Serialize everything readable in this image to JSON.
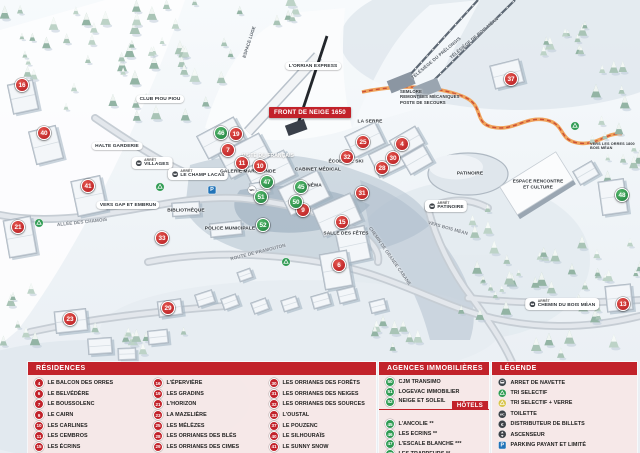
{
  "colors": {
    "legend_red": "#c2222a",
    "marker_red": "#cd2127",
    "marker_green": "#2f9b53",
    "parking_blue": "#2173b8",
    "luge_orange": "#f0a35c"
  },
  "map": {
    "banner": "FRONT DE NEIGE 1650",
    "stop_prefix": "ARRÊT",
    "red_markers": [
      {
        "n": "16",
        "x": 22,
        "y": 85
      },
      {
        "n": "40",
        "x": 44,
        "y": 133
      },
      {
        "n": "41",
        "x": 88,
        "y": 186
      },
      {
        "n": "21",
        "x": 18,
        "y": 227
      },
      {
        "n": "23",
        "x": 70,
        "y": 319
      },
      {
        "n": "29",
        "x": 168,
        "y": 308
      },
      {
        "n": "33",
        "x": 162,
        "y": 238
      },
      {
        "n": "19",
        "x": 236,
        "y": 134
      },
      {
        "n": "7",
        "x": 228,
        "y": 150
      },
      {
        "n": "11",
        "x": 242,
        "y": 163
      },
      {
        "n": "10",
        "x": 260,
        "y": 166
      },
      {
        "n": "9",
        "x": 303,
        "y": 210
      },
      {
        "n": "15",
        "x": 342,
        "y": 222
      },
      {
        "n": "31",
        "x": 362,
        "y": 193
      },
      {
        "n": "6",
        "x": 339,
        "y": 265
      },
      {
        "n": "25",
        "x": 363,
        "y": 142
      },
      {
        "n": "32",
        "x": 347,
        "y": 157
      },
      {
        "n": "4",
        "x": 402,
        "y": 144
      },
      {
        "n": "30",
        "x": 393,
        "y": 158
      },
      {
        "n": "28",
        "x": 382,
        "y": 168
      },
      {
        "n": "37",
        "x": 511,
        "y": 79
      },
      {
        "n": "13",
        "x": 623,
        "y": 304
      }
    ],
    "green_markers": [
      {
        "n": "46",
        "x": 221,
        "y": 133
      },
      {
        "n": "45",
        "x": 301,
        "y": 187
      },
      {
        "n": "47",
        "x": 267,
        "y": 182
      },
      {
        "n": "51",
        "x": 261,
        "y": 197
      },
      {
        "n": "50",
        "x": 296,
        "y": 202
      },
      {
        "n": "52",
        "x": 263,
        "y": 225
      },
      {
        "n": "48",
        "x": 622,
        "y": 195
      }
    ],
    "icons": [
      {
        "t": "parking",
        "x": 212,
        "y": 190
      },
      {
        "t": "wc-map",
        "x": 252,
        "y": 190
      },
      {
        "t": "recycle",
        "x": 39,
        "y": 223
      },
      {
        "t": "recycle",
        "x": 160,
        "y": 187
      },
      {
        "t": "recycle",
        "x": 286,
        "y": 262
      },
      {
        "t": "recycle",
        "x": 575,
        "y": 126
      }
    ],
    "labels": [
      {
        "t": "CLUB PIOU PIOU",
        "x": 160,
        "y": 99,
        "s": "pill"
      },
      {
        "t": "HALTE GARDERIE",
        "x": 117,
        "y": 146,
        "s": "pill"
      },
      {
        "t": "VILLAGES",
        "x": 152,
        "y": 163,
        "s": "bus"
      },
      {
        "t": "LE CHAMP LACAS",
        "x": 198,
        "y": 174,
        "s": "bus"
      },
      {
        "t": "VERS GAP ET EMBRUN",
        "x": 128,
        "y": 205,
        "s": "pill"
      },
      {
        "t": "GALERIE MARCHANDE",
        "x": 248,
        "y": 172,
        "s": "plain"
      },
      {
        "t": "BIBLIOTHÈQUE",
        "x": 186,
        "y": 211,
        "s": "plain"
      },
      {
        "t": "POLICE MUNICIPALE",
        "x": 230,
        "y": 229,
        "s": "plain"
      },
      {
        "t": "CABINET MÉDICAL",
        "x": 318,
        "y": 170,
        "s": "plain"
      },
      {
        "t": "CINÉMA",
        "x": 312,
        "y": 186,
        "s": "plain"
      },
      {
        "t": "ÉCOLE DE SKI",
        "x": 346,
        "y": 162,
        "s": "plain"
      },
      {
        "t": "LA SERRE",
        "x": 370,
        "y": 122,
        "s": "plain"
      },
      {
        "t": "SALLE DES FÊTES",
        "x": 346,
        "y": 234,
        "s": "plain"
      },
      {
        "t": "PISTE DU FRANÇAIS",
        "x": 268,
        "y": 156,
        "s": "white"
      },
      {
        "t": "SEMLORE\nREMONTÉES MÉCANIQUES\nPOSTE DE SECOURS",
        "x": 400,
        "y": 97,
        "s": "multi"
      },
      {
        "t": "ESPACE LUGE",
        "x": 249,
        "y": 42,
        "s": "rot",
        "r": -72
      },
      {
        "t": "L'ORRIAN EXPRESS",
        "x": 313,
        "y": 66,
        "s": "pill"
      },
      {
        "t": "TÉLÉSIÈGE DU PRÉLONGIS",
        "x": 436,
        "y": 58,
        "s": "rot",
        "r": -40
      },
      {
        "t": "TÉLÉSIÈGE DE BOIS MÉAN",
        "x": 474,
        "y": 38,
        "s": "rot",
        "r": -40
      },
      {
        "t": "PATINOIRE",
        "x": 470,
        "y": 174,
        "s": "plain"
      },
      {
        "t": "PATINOIRE",
        "x": 446,
        "y": 206,
        "s": "bus"
      },
      {
        "t": "ESPACE RENCONTRE\nET CULTURE",
        "x": 538,
        "y": 184,
        "s": "multi-c"
      },
      {
        "t": "VERS BOIS MÉAN",
        "x": 448,
        "y": 228,
        "s": "road",
        "r": 16
      },
      {
        "t": "VERS LES ORRES 1800\nBOIS MÉAN",
        "x": 590,
        "y": 146,
        "s": "tiny"
      },
      {
        "t": "CHEMIN DU BOIS MÉAN",
        "x": 562,
        "y": 304,
        "s": "bus"
      },
      {
        "t": "ALLÉE DES CHAMOIS",
        "x": 82,
        "y": 222,
        "s": "road",
        "r": -6
      },
      {
        "t": "ROUTE DE PRAMOUTON",
        "x": 258,
        "y": 252,
        "s": "road",
        "r": -14
      },
      {
        "t": "CHEMIN DE GRANDE CABANE",
        "x": 390,
        "y": 256,
        "s": "road",
        "r": 55
      }
    ]
  },
  "legend": {
    "residences": {
      "title": "RÉSIDENCES",
      "columns": [
        [
          {
            "n": "4",
            "label": "LE BALCON DES ORRES"
          },
          {
            "n": "6",
            "label": "LE BELVÉDÈRE"
          },
          {
            "n": "7",
            "label": "LE BOUSSOLENC"
          },
          {
            "n": "9",
            "label": "LE CAIRN"
          },
          {
            "n": "10",
            "label": "LES CARLINES"
          },
          {
            "n": "11",
            "label": "LES CEMBROS"
          },
          {
            "n": "15",
            "label": "LES ÉCRINS"
          }
        ],
        [
          {
            "n": "16",
            "label": "L'ÉPERVIÈRE"
          },
          {
            "n": "19",
            "label": "LES GRADINS"
          },
          {
            "n": "21",
            "label": "L'HORIZON"
          },
          {
            "n": "23",
            "label": "LA MAZELIÈRE"
          },
          {
            "n": "25",
            "label": "LES MÉLÈZES"
          },
          {
            "n": "28",
            "label": "LES ORRIANES DES BLÉS"
          },
          {
            "n": "29",
            "label": "LES ORRIANES DES CIMES"
          }
        ],
        [
          {
            "n": "30",
            "label": "LES ORRIANES DES FORÊTS"
          },
          {
            "n": "31",
            "label": "LES ORRIANES DES NEIGES"
          },
          {
            "n": "32",
            "label": "LES ORRIANES DES SOURCES"
          },
          {
            "n": "33",
            "label": "L'OUSTAL"
          },
          {
            "n": "37",
            "label": "LE POUZENC"
          },
          {
            "n": "40",
            "label": "LE SILHOURAÏS"
          },
          {
            "n": "41",
            "label": "LE SUNNY SNOW"
          }
        ]
      ]
    },
    "agences": {
      "title": "AGENCES IMMOBILIÈRES",
      "items": [
        {
          "n": "50",
          "label": "CJM TRANSIMO"
        },
        {
          "n": "51",
          "label": "LOGEVAC IMMOBILIER"
        },
        {
          "n": "52",
          "label": "NEIGE ET SOLEIL"
        }
      ]
    },
    "hotels": {
      "title": "HÔTELS",
      "items": [
        {
          "n": "45",
          "label": "L'ANCOLIE **"
        },
        {
          "n": "46",
          "label": "LES ECRINS **"
        },
        {
          "n": "47",
          "label": "L'ESCALE BLANCHE ***"
        },
        {
          "n": "48",
          "label": "LES TRAPPEURS **"
        }
      ]
    },
    "legende": {
      "title": "LÉGENDE",
      "items": [
        {
          "icon": "bus",
          "label": "ARRET DE NAVETTE"
        },
        {
          "icon": "recycle",
          "label": "TRI SELECTIF"
        },
        {
          "icon": "recycle-verre",
          "label": "TRI SELECTIF + VERRE"
        },
        {
          "icon": "wc",
          "label": "TOILETTE"
        },
        {
          "icon": "euro",
          "label": "DISTRIBUTEUR DE BILLETS"
        },
        {
          "icon": "ascenseur",
          "label": "ASCENSEUR"
        },
        {
          "icon": "parking",
          "label": "PARKING PAYANT ET LIMITÉ"
        }
      ]
    }
  }
}
